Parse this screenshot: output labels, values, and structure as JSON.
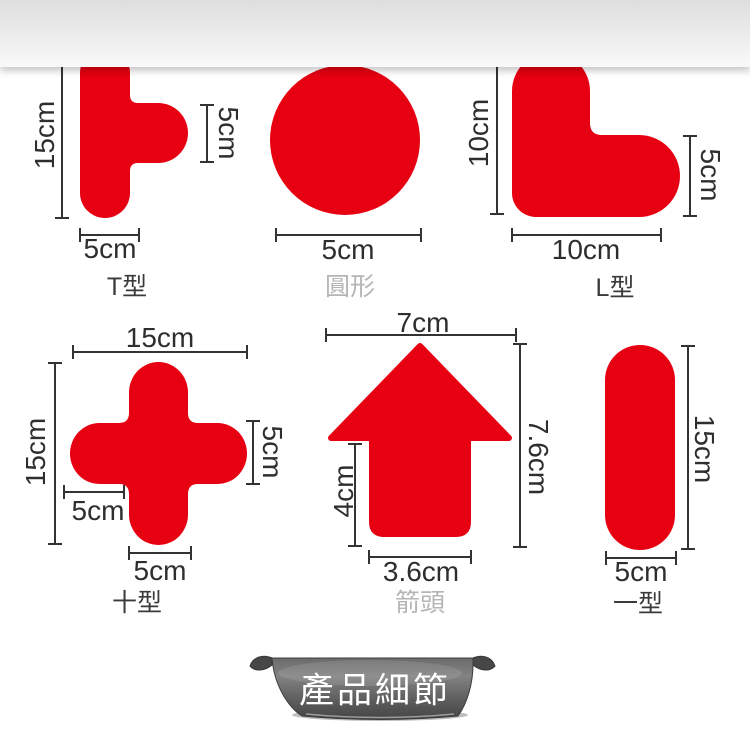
{
  "colors": {
    "shape_red": "#e60012",
    "dim_line": "#333333",
    "dim_text": "#2e2e2e",
    "name_dark": "#3a3a3a",
    "name_light": "#b5b5b5",
    "banner_text": "#ffffff",
    "ribbon_gray": "#5c5c5c",
    "band_gray": "#ebebeb"
  },
  "shapes": [
    {
      "id": "t-shape",
      "name_label": "T型",
      "dims": {
        "top": "10cm",
        "left": "15cm",
        "right": "5cm",
        "bottom": "5cm"
      }
    },
    {
      "id": "circle",
      "name_label": "圓形",
      "dims": {
        "bottom": "5cm"
      }
    },
    {
      "id": "l-shape",
      "name_label": "L型",
      "dims": {
        "left": "10cm",
        "right": "5cm",
        "bottom": "10cm"
      }
    },
    {
      "id": "cross",
      "name_label": "十型",
      "dims": {
        "top": "15cm",
        "left": "15cm",
        "right": "5cm",
        "inner": "5cm",
        "bottom": "5cm"
      }
    },
    {
      "id": "arrow",
      "name_label": "箭頭",
      "dims": {
        "top": "7cm",
        "left": "4cm",
        "right": "7.6cm",
        "bottom": "3.6cm"
      }
    },
    {
      "id": "bar",
      "name_label": "一型",
      "dims": {
        "right": "15cm",
        "bottom": "5cm"
      }
    }
  ],
  "banner": {
    "title": "產品細節"
  }
}
